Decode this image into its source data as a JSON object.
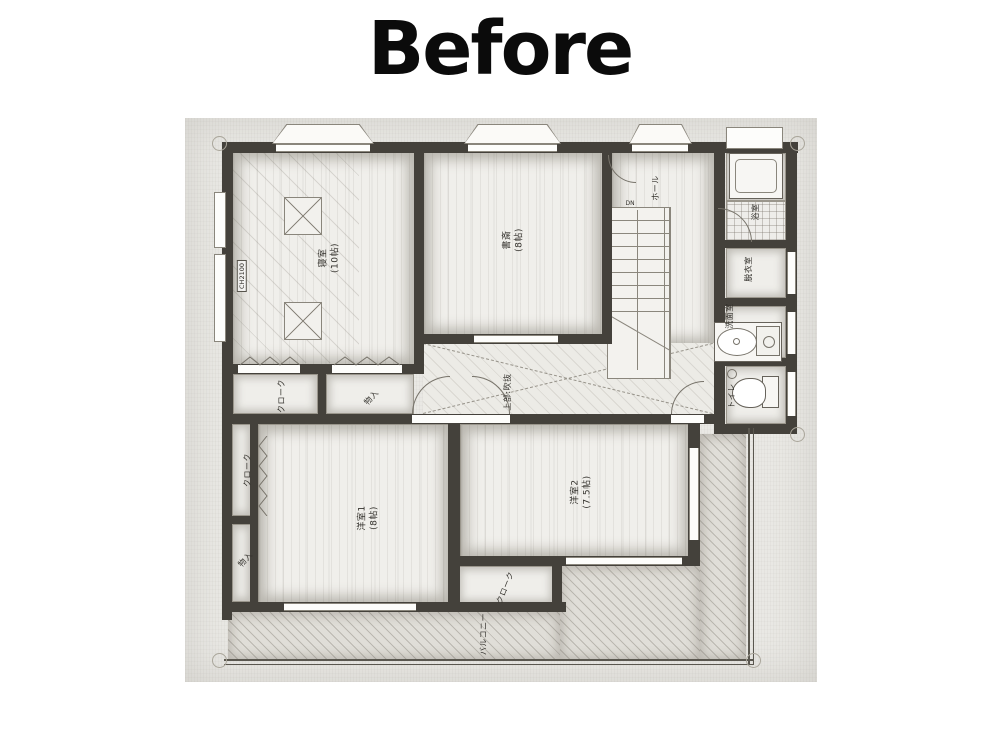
{
  "title": "Before",
  "plan": {
    "rooms": {
      "bedroom": {
        "label": "寝室\n(10帖)"
      },
      "study": {
        "label": "書斎\n(8帖)"
      },
      "hall": {
        "label": "ホール"
      },
      "bath": {
        "label": "浴室"
      },
      "dressing_room": {
        "label": "脱衣室"
      },
      "washroom": {
        "label": "洗面室"
      },
      "toilet": {
        "label": "トイレ"
      },
      "cloak_upper": {
        "label": "クローク"
      },
      "storage_upper": {
        "label": "物入"
      },
      "void_over_stairwell": {
        "label": "上部:吹抜"
      },
      "cloak_west": {
        "label": "クローク"
      },
      "storage_west": {
        "label": "物入"
      },
      "western_room_1": {
        "label": "洋室1\n(8帖)"
      },
      "western_room_2": {
        "label": "洋室2\n(7.5帖)"
      },
      "cloak_south": {
        "label": "クローク"
      },
      "balcony": {
        "label": "バルコニー"
      }
    },
    "annotations": {
      "ceiling_height": "CH2100",
      "stair_direction": "DN"
    },
    "colors": {
      "wall": "#44413b",
      "paper": "#e9e8e4",
      "title_text": "#0b0b0b"
    }
  }
}
